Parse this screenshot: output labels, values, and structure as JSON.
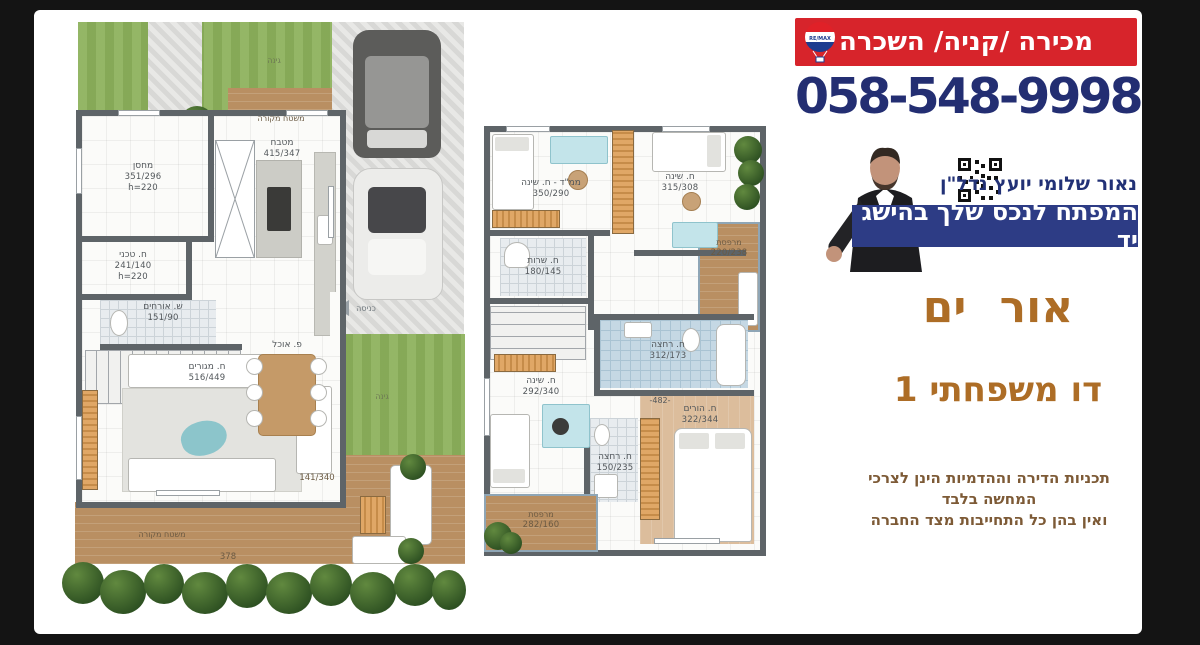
{
  "header": {
    "offer_text": "מכירה /קניה/ השכרה",
    "phone": "058-548-9998",
    "logo": "remax-balloon-icon"
  },
  "agent": {
    "name": "נאור שלומי יועץ נדל\"ן",
    "tagline": "המפתח לנכס שלך בהישג יד"
  },
  "project": {
    "name": "אור ים",
    "unit": "דו משפחתי 1"
  },
  "disclaimer": {
    "line1": "תכניות הדירה וההדמיות הינן לצרכי",
    "line2": "המחשה בלבד",
    "line3": "ואין בהן כל התחייבות מצד החברה"
  },
  "colors": {
    "banner_red": "#d7242b",
    "phone_navy": "#232e72",
    "tagline_navy": "#2d3c85",
    "title_brown": "#ad6d26"
  },
  "plans": {
    "ground": {
      "rooms": [
        {
          "name": "מחסן",
          "dims": "351/296",
          "height": "h=220"
        },
        {
          "name": "מטבח",
          "dims": "415/347"
        },
        {
          "name": "ח. טכני",
          "dims": "241/140",
          "height": "h=220"
        },
        {
          "name": "ש. אורחים",
          "dims": "151/90"
        },
        {
          "name": "ח. מגורים",
          "dims": "516/449"
        },
        {
          "name": "פ. אוכל"
        },
        {
          "name": "משטח מקורה"
        },
        {
          "name": "משטח מקורה",
          "dims": "141/340",
          "extra": "378"
        }
      ],
      "labels": {
        "entrance": "כניסה",
        "garden": "גינה"
      }
    },
    "upper": {
      "rooms": [
        {
          "name": "ממ\"ד - ח. שינה",
          "dims": "350/290"
        },
        {
          "name": "ח. שינה",
          "dims": "315/308"
        },
        {
          "name": "מרפסת",
          "dims": "220/238"
        },
        {
          "name": "ח. שרות",
          "dims": "180/145"
        },
        {
          "name": "ח. רחצה",
          "dims": "312/173"
        },
        {
          "name": "ח. שינה",
          "dims": "292/340"
        },
        {
          "name": "ח. הורים",
          "dims": "322/344"
        },
        {
          "name": "ח. רחצה",
          "dims": "150/235"
        },
        {
          "name": "מרפסת",
          "dims": "282/160"
        },
        {
          "dims": "-482-"
        }
      ]
    }
  }
}
